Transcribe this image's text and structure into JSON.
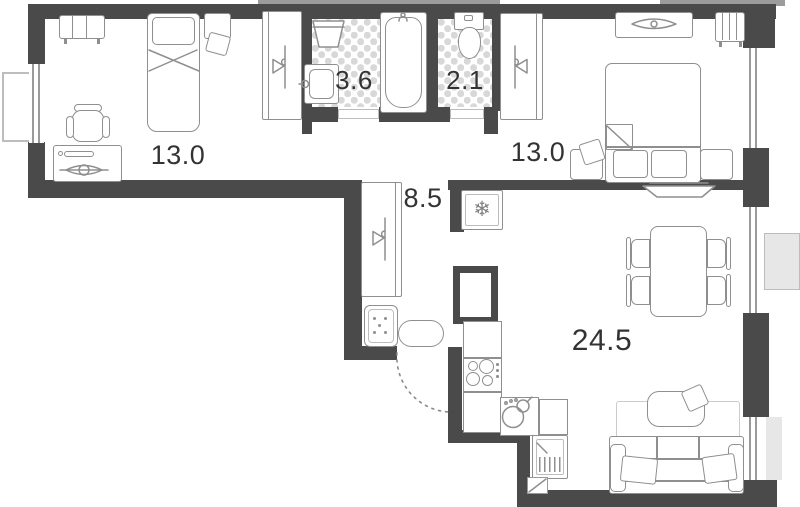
{
  "floorplan": {
    "title": "apartment-floor-plan",
    "rooms": [
      {
        "name": "bedroom-left",
        "area_label": "13.0"
      },
      {
        "name": "bathroom",
        "area_label": "3.6"
      },
      {
        "name": "toilet",
        "area_label": "2.1"
      },
      {
        "name": "bedroom-right",
        "area_label": "13.0"
      },
      {
        "name": "hallway",
        "area_label": "8.5"
      },
      {
        "name": "kitchen-living-room",
        "area_label": "24.5"
      }
    ],
    "icons": {
      "fridge_snowflake": "❄"
    },
    "colors": {
      "wall": "#4a4a4a",
      "furniture": "#8f8f8f",
      "furniture_light": "#bdbdbd",
      "label": "#333333",
      "tile": "#d8d8d8",
      "balcony_fill": "#e7e7e7",
      "balcony_line": "#bdbdbd",
      "rug": "#cccccc",
      "exterior_shade": "#9c9c9c"
    }
  }
}
